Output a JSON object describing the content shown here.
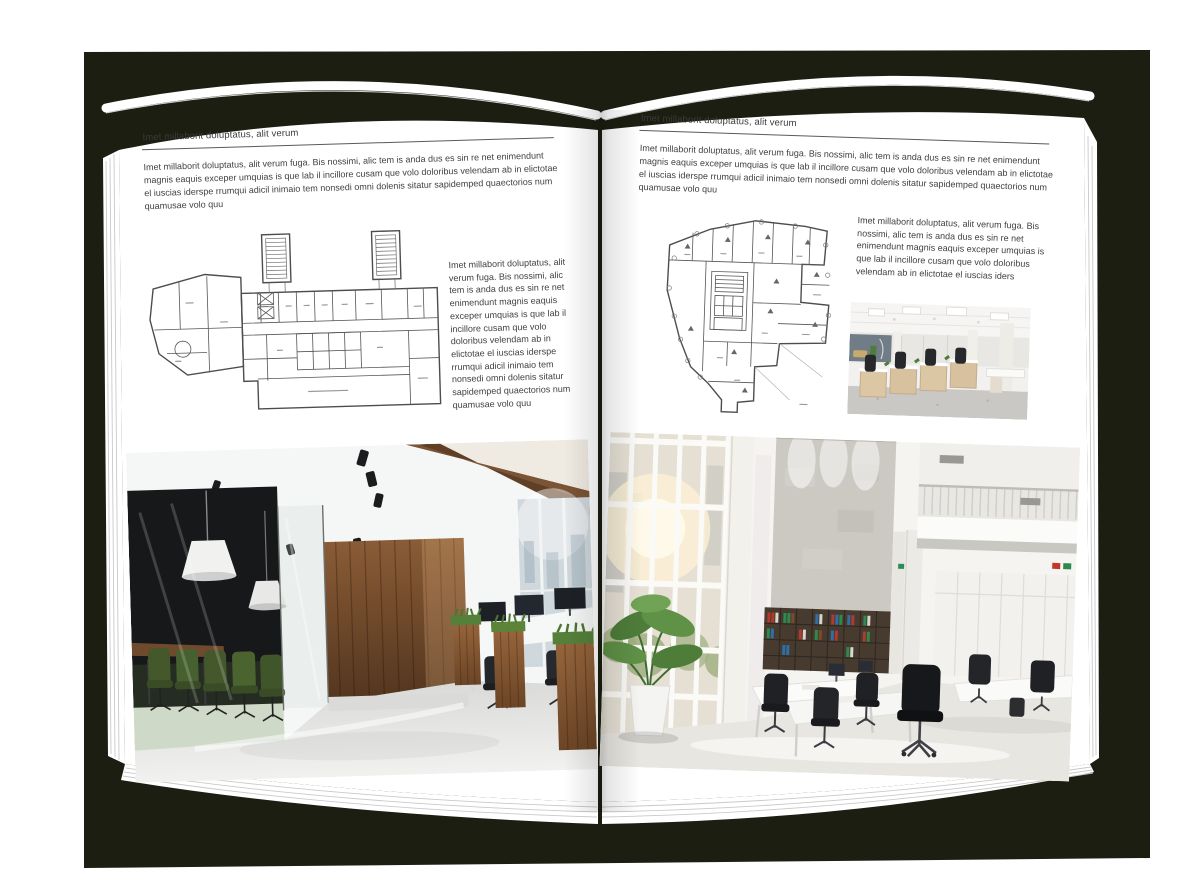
{
  "book": {
    "canvas_color": "#ffffff",
    "backdrop_color": "#1c1e11",
    "page_color": "#ffffff"
  },
  "left_page": {
    "header": "Imet millaborit doluptatus, alit verum",
    "intro": "Imet millaborit doluptatus, alit verum fuga. Bis nossimi, alic tem is anda dus es sin re net enimendunt magnis eaquis exceper umquias is que lab il incillore cusam que volo doloribus velendam ab in elictotae el iuscias iderspe rrumqui adicil inimaio tem nonsedi omni dolenis sitatur sapidemped quaectorios num quamusae volo quu",
    "side_text": "Imet millaborit doluptatus, alit verum fuga. Bis nossimi, alic tem is anda dus es sin re net enimendunt magnis eaquis exceper umquias is que lab il incillore cusam que volo doloribus velendam ab in elictotae el iuscias iderspe rrumqui adicil inimaio tem nonsedi omni dolenis sitatur sapidemped quaectorios num quamusae volo quu",
    "floorplan_name": "rectangular-building-floorplan",
    "photo_name": "wood-and-glass-office-interior-photo"
  },
  "right_page": {
    "header": "Imet millaborit doluptatus, alit verum",
    "intro": "Imet millaborit doluptatus, alit verum fuga. Bis nossimi, alic tem is anda dus es sin re net enimendunt magnis eaquis exceper umquias is que lab il incillore cusam que volo doloribus velendam ab in elictotae el iuscias iderspe rrumqui adicil inimaio tem nonsedi omni dolenis sitatur sapidemped quaectorios num quamusae volo quu",
    "side_text": "Imet millaborit doluptatus, alit verum fuga. Bis nossimi, alic tem is anda dus es sin re net enimendunt magnis eaquis exceper umquias is que lab il incillore cusam que volo doloribus velendam ab in elictotae el iuscias iders",
    "floorplan_name": "irregular-building-floorplan",
    "small_photo_name": "open-plan-office-desks-photo",
    "photo_name": "bright-atrium-office-interior-photo"
  }
}
